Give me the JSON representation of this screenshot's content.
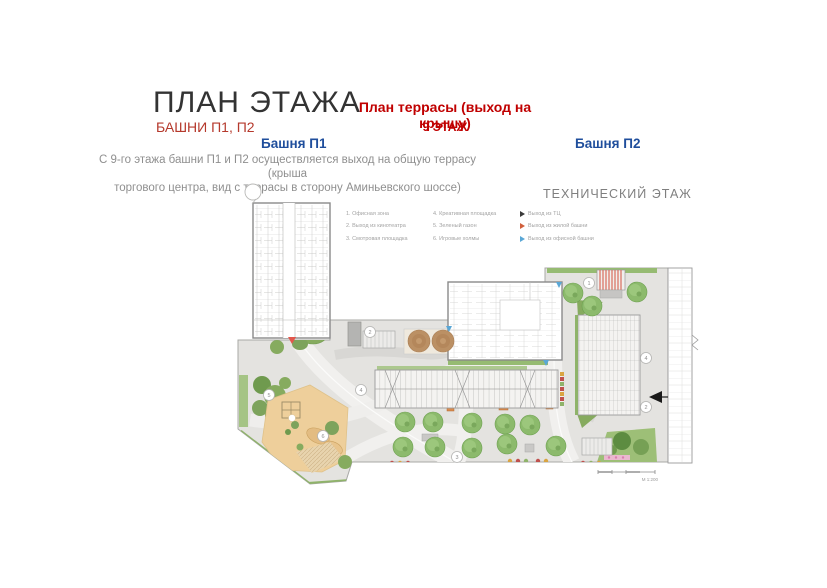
{
  "slide": {
    "title": "ПЛАН ЭТАЖА",
    "subtitle": "БАШНИ П1, П2",
    "terrace_heading": "План террасы (выход на крышу)",
    "floor_label": "9 ЭТАЖ",
    "tower1_label": "Башня П1",
    "tower2_label": "Башня П2",
    "description_line1": "С 9-го этажа башни П1 и П2 осуществляется выход на общую террасу (крыша",
    "description_line2": "торгового центра, вид с террасы  в сторону Аминьевского шоссе)",
    "technical_floor_label": "ТЕХНИЧЕСКИЙ ЭТАЖ"
  },
  "legend": {
    "areas": [
      "1. Офисная зона",
      "2. Выход из кинотеатра",
      "3. Смотровая площадка",
      "4. Креативная площадка",
      "5. Зеленый газон",
      "6. Игровые холмы"
    ],
    "exits": [
      {
        "label": "Выход из ТЦ",
        "color": "#3a3a3a"
      },
      {
        "label": "Выход из жилой башни",
        "color": "#d1603d"
      },
      {
        "label": "Выход из офисной башни",
        "color": "#5aa7d6"
      }
    ]
  },
  "plan": {
    "callouts": [
      "1",
      "2",
      "3",
      "4",
      "2",
      "5",
      "4",
      "6"
    ],
    "scale_label": "М 1:200",
    "colors": {
      "accent_red": "#c00000",
      "subtitle_red": "#b5392c",
      "accent_blue": "#1f4e9c",
      "terrace_gray": "#e4e3e0",
      "green": "#86ab5f",
      "sand": "#eecf9b"
    }
  }
}
